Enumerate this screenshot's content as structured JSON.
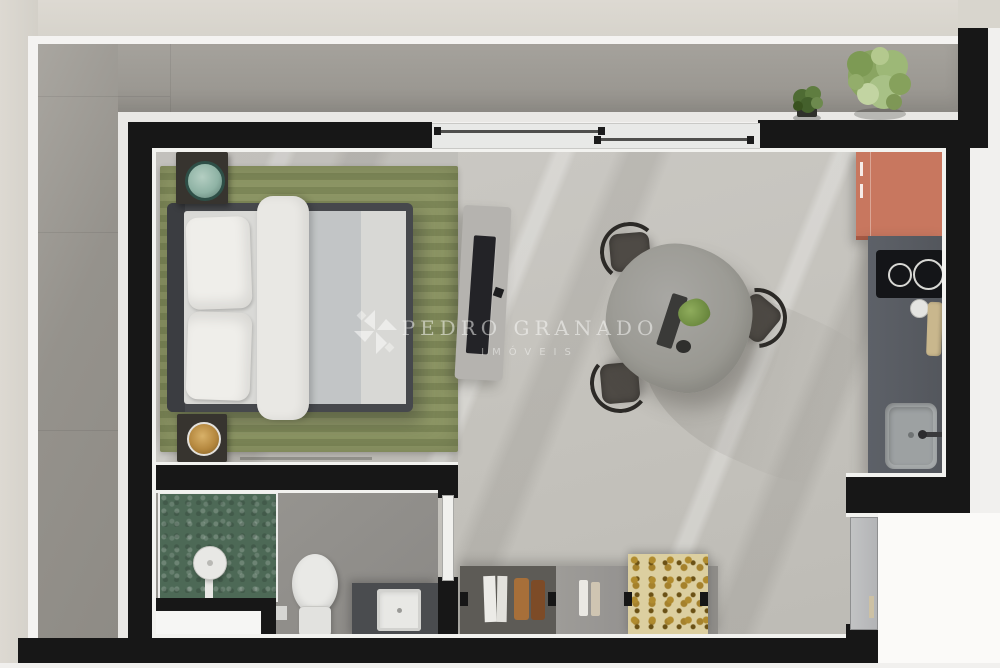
{
  "watermark": {
    "brand": "PEDRO GRANADO",
    "tagline": "IMÓVEIS"
  },
  "plan": {
    "type": "studio-apartment-floor-plan-top-view",
    "rooms": [
      "terrace",
      "bedroom",
      "living-dining",
      "kitchen",
      "bathroom"
    ],
    "furniture": [
      "double-bed",
      "nightstand-with-plant",
      "nightstand-with-bowl",
      "striped-rug",
      "tv-console",
      "dining-table",
      "dining-chairs-x3",
      "sideboard-with-decor",
      "fridge-counter",
      "cooktop",
      "cutting-board",
      "kitchen-sink",
      "shower-area",
      "shower-column",
      "toilet",
      "vanity-sink",
      "entrance-door",
      "bathroom-door",
      "sliding-window",
      "terrace-plants"
    ],
    "colors": {
      "wall_black": "#171717",
      "terrace_floor": "#9b9893",
      "interior_floor": "#c6c4bf",
      "rug_green_light": "#8d9665",
      "rug_green_dark": "#7c8657",
      "shower_tile_green": "#4d6956",
      "fridge_accent_orange": "#c8775f",
      "kitchen_counter": "#585c62",
      "bed_frame": "#46484c",
      "outer_border_beige": "#d8d5cd",
      "watermark_white": "#fcfcfa"
    }
  }
}
